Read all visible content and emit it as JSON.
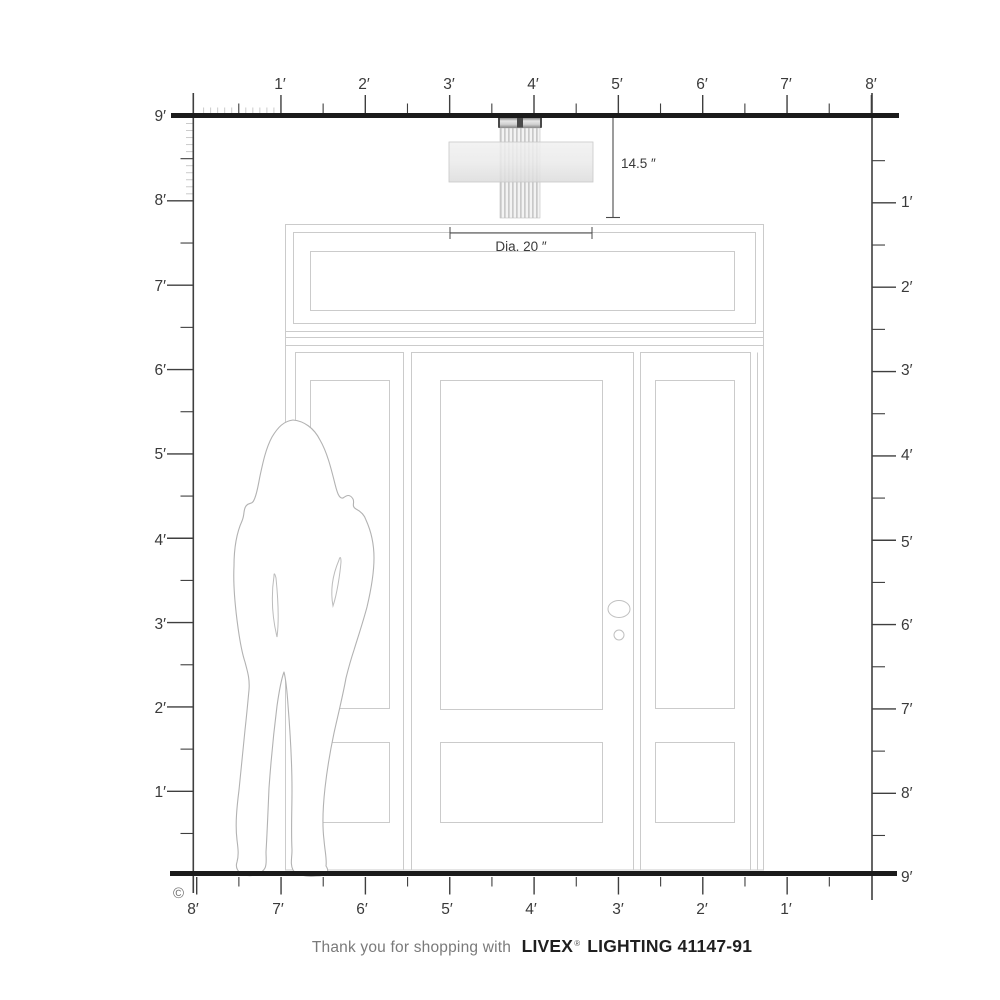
{
  "diagram": {
    "copyright": "©",
    "fixture": {
      "height_label": "14.5 ″",
      "diameter_label": "Dia. 20 ″"
    }
  },
  "rulers": {
    "unit": "feet",
    "top": [
      "1′",
      "2′",
      "3′",
      "4′",
      "5′",
      "6′",
      "7′",
      "8′"
    ],
    "left": [
      "9′",
      "8′",
      "7′",
      "6′",
      "5′",
      "4′",
      "3′",
      "2′",
      "1′"
    ],
    "right": [
      "1′",
      "2′",
      "3′",
      "4′",
      "5′",
      "6′",
      "7′",
      "8′",
      "9′"
    ],
    "bottom": [
      "8′",
      "7′",
      "6′",
      "5′",
      "4′",
      "3′",
      "2′",
      "1′"
    ]
  },
  "footer": {
    "message": "Thank you for shopping with",
    "brand": "LIVEX",
    "registered": "®",
    "product": "LIGHTING 41147-91"
  },
  "colors": {
    "axis": "#3f3f3f",
    "thick_line": "#1b1b1b",
    "door_outline": "#cbcbcb",
    "silhouette_outline": "#b2b2b2",
    "minor_tick": "#c5c5c5"
  }
}
